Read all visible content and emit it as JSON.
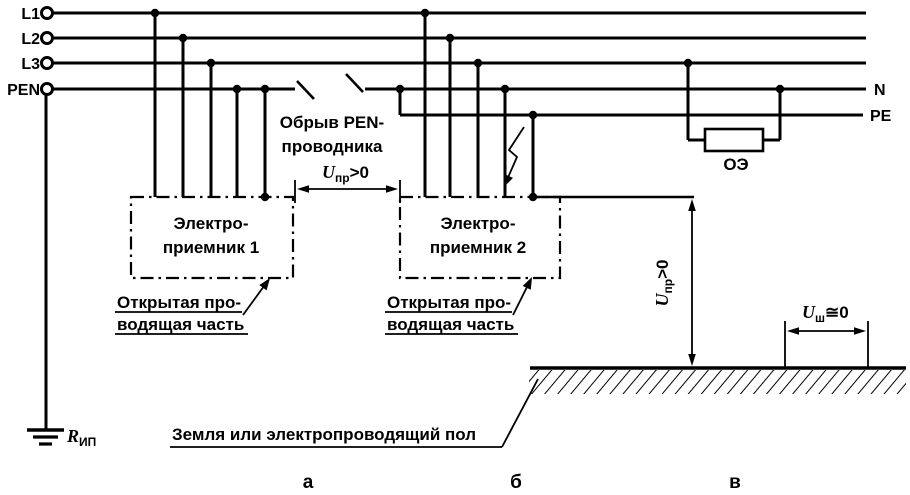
{
  "colors": {
    "ink": "#000000",
    "paper": "#ffffff"
  },
  "supply_terminals": {
    "l1": "L1",
    "l2": "L2",
    "l3": "L3",
    "pen": "PEN"
  },
  "right_conductors": {
    "n": "N",
    "pe": "PE"
  },
  "pen_break": {
    "line1": "Обрыв PEN-",
    "line2": "проводника"
  },
  "touch_voltage": {
    "symbol": "U",
    "subscript": "пр",
    "relation": ">0"
  },
  "step_voltage": {
    "symbol": "U",
    "subscript": "ш",
    "relation": "≅0"
  },
  "receiver1": {
    "line1": "Электро-",
    "line2": "приемник 1"
  },
  "receiver2": {
    "line1": "Электро-",
    "line2": "приемник 2"
  },
  "exposed_part": {
    "line1": "Открытая про-",
    "line2": "водящая часть"
  },
  "single_phase_load": {
    "label": "ОЭ"
  },
  "source_ground": {
    "symbol": "R",
    "subscript": "ИП"
  },
  "earth_label": "Земля или электропроводящий пол",
  "captions": {
    "a": "а",
    "b": "б",
    "v": "в"
  }
}
